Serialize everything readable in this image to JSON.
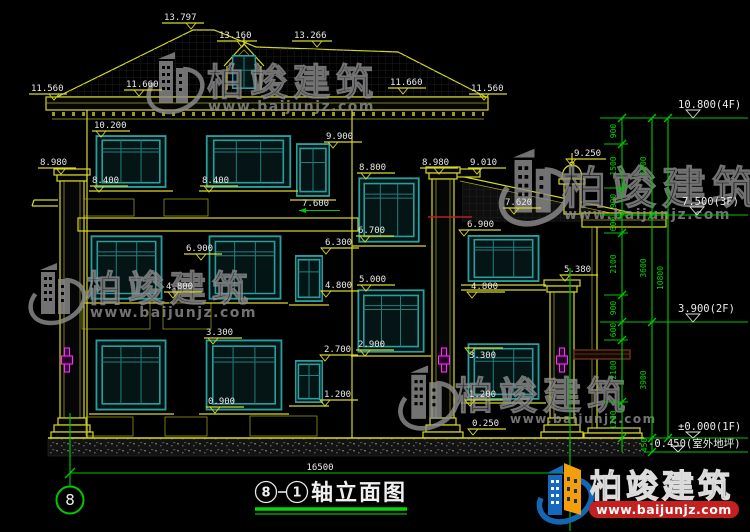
{
  "watermark": {
    "brand": "柏竣建筑",
    "url": "www.baijunjz.com"
  },
  "logo": {
    "brand": "柏竣建筑",
    "url": "www.baijunjz.com"
  },
  "drawing": {
    "title": {
      "axis_a": "8",
      "axis_b": "1",
      "name": "轴立面图"
    },
    "axis_bubble_left": "8",
    "overall_width": "16500",
    "levels": [
      "10.800(4F)",
      "7.500(3F)",
      "3.900(2F)",
      "±0.000(1F)",
      "-0.450(室外地坪)"
    ],
    "chain_inner": [
      "900",
      "1500",
      "900",
      "600",
      "2100",
      "900",
      "600",
      "2100",
      "1200"
    ],
    "chain_mid": [
      "3300",
      "3600",
      "3900"
    ],
    "chain_outer": [
      "10800"
    ],
    "chain_450": "450",
    "marks": [
      "13.797",
      "13.160",
      "13.266",
      "11.560",
      "11.660",
      "11.660",
      "11.560",
      "10.200",
      "9.900",
      "8.980",
      "8.400",
      "8.400",
      "8.800",
      "8.980",
      "9.010",
      "9.250",
      "7.620",
      "7.600",
      "6.900",
      "6.700",
      "6.300",
      "6.900",
      "5.380",
      "5.000",
      "4.800",
      "4.800",
      "4.800",
      "3.300",
      "3.300",
      "2.900",
      "2.700",
      "1.200",
      "1.200",
      "0.900",
      "0.250"
    ]
  },
  "colors": {
    "background": "#000000",
    "outline_yellow": "#d9d926",
    "window_teal": "#2a9d9d",
    "dimension_green": "#00c800",
    "text_white": "#eaeaea",
    "lamp_magenta": "#ff2bff",
    "logo_blue": "#1467b5",
    "logo_orange": "#f59e0b",
    "logo_red": "#c3201f"
  }
}
